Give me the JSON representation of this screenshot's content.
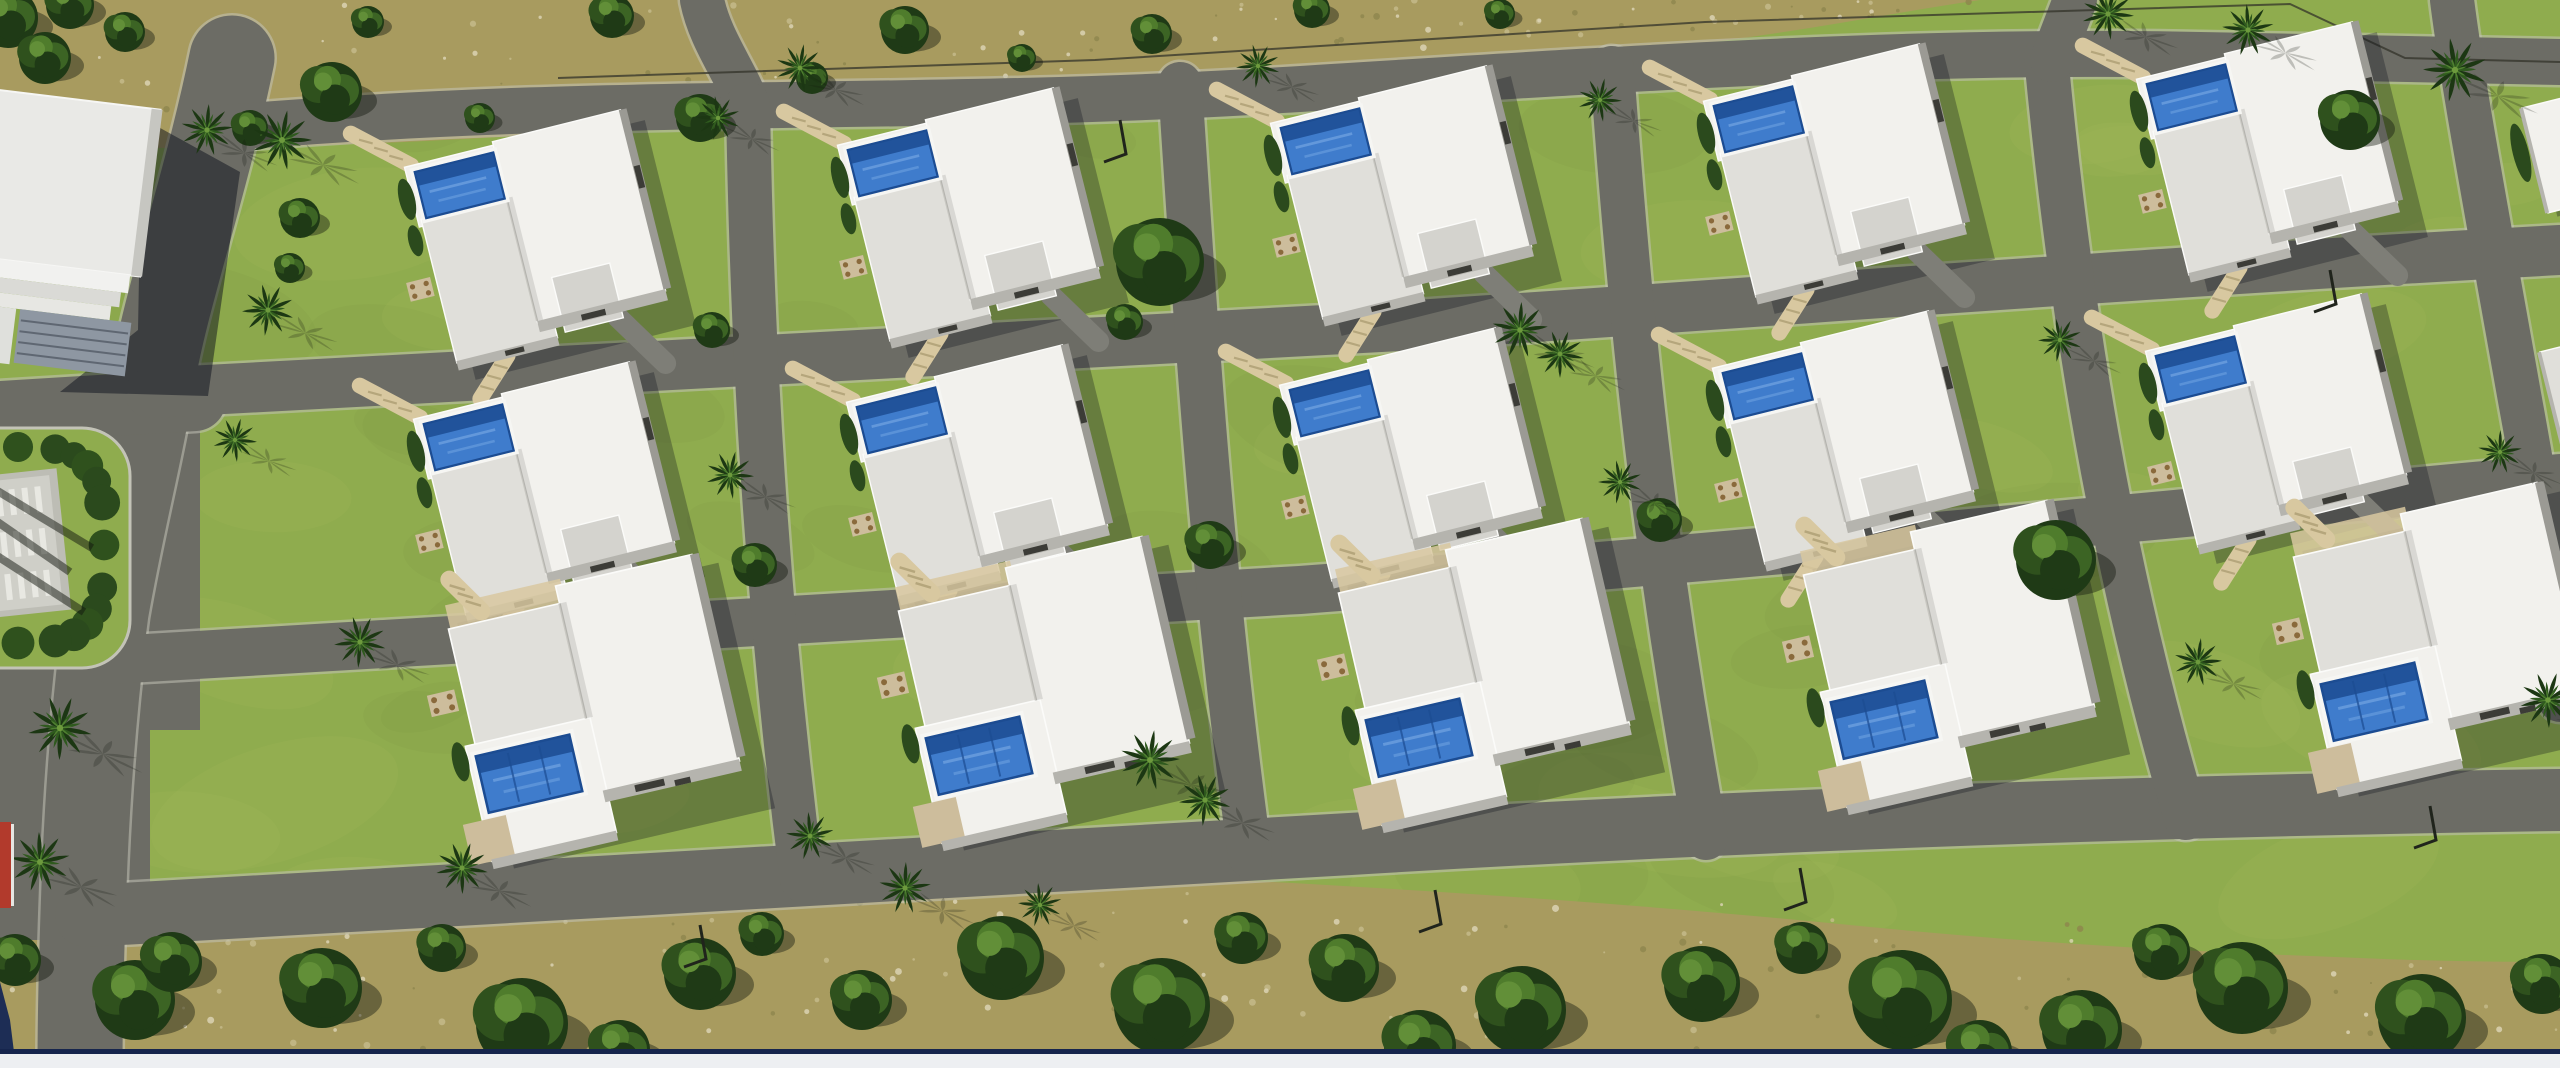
{
  "meta": {
    "description": "Aerial 3D architectural rendering of a residential villa development with white flat-roof houses, blue pools, curved asphalt streets, palm trees and scrubland",
    "canvas": {
      "w": 2560,
      "h": 1068
    }
  },
  "palette": {
    "grass": "#8fac4e",
    "grassLight": "#a6bd60",
    "grassShade": "#7a9842",
    "asphalt": "#6c6c65",
    "curb": "#c3c3b7",
    "scrub": "#a89b5f",
    "scrubDark": "#8d864d",
    "scrubLight": "#c6bb8c",
    "stone": "#ddd6b8",
    "treeDark": "#1f3a16",
    "tree": "#2f511d",
    "treeMid": "#3c6424",
    "treeLight": "#4f7c2c",
    "treeHi": "#628f38",
    "palmDark": "#1c3713",
    "palm": "#2f5a1e",
    "palmLight": "#4f8030",
    "palmCore": "#6d9a3d",
    "shadow": "rgba(18,24,14,0.42)",
    "buildShadow": "rgba(14,18,28,0.30)",
    "clubShadow": "rgba(12,16,28,0.50)",
    "roofWhite": "#f2f1ed",
    "roofGray": "#e0dfda",
    "roofGray2": "#d4d3ce",
    "roofLine": "#fbfbf9",
    "wall": "#b5b4ae",
    "wallDark": "#9b9a94",
    "slot": "#3c3c37",
    "poolRim": "#f6f6f3",
    "poolDeep": "#1c4c92",
    "pool": "#3f7ccc",
    "poolLight": "#76a7e4",
    "deck": "#cdbd9c",
    "path": "#d8c8a0",
    "pathDark": "#b5a67c",
    "drive": "#7e7e77",
    "hedge": "#2b4a1d",
    "monument": "#cfcfc8",
    "monumentIn": "#bdbdb5",
    "monumentBar": "#ececе6",
    "facade": "#8e97a2",
    "facadeLine": "#5f6772",
    "clubRoof": "#e9e9e6",
    "clubEdge": "#c6c6c1",
    "band1": "#f1f1ef",
    "band2": "#dadad6",
    "band3": "#e7e7e3",
    "sideBlock": "#dfe0dc",
    "red": "#b23a2c",
    "redEdge": "#e6e6e2",
    "navy": "#1d2d55",
    "navyLine": "#16254d",
    "bottomBar": "#edeff2",
    "fence": "#33332a",
    "lamp": "#20241c"
  },
  "scrub": {
    "top_path": "M0,0 L1980,0 C1860,18 1760,40 1620,52 C1430,66 1300,62 1150,80 C980,100 860,108 700,122 C540,136 420,142 300,146 C200,150 90,148 0,142 Z",
    "bottom_path": "M0,1054 L0,938 C150,934 290,922 430,912 C600,900 760,888 930,882 C1060,878 1180,876 1310,884 C1500,895 1680,908 1860,926 C2040,944 2200,952 2360,958 C2430,961 2500,962 2560,962 L2560,1054 Z",
    "speckles_top": 90,
    "speckles_bottom": 150,
    "mottle": 70,
    "seed": 7
  },
  "roads": [
    {
      "d": "M 232,58 C 205,190 165,300 152,382 C 140,455 122,520 106,612 C 96,690 89,770 85,860 C 82,935 80,1000 80,1068",
      "w": 85,
      "name": "main-avenue"
    },
    {
      "d": "M 0,412 L 195,400",
      "w": 62,
      "name": "west-spur-road"
    },
    {
      "d": "M 225,128 C 600,96 900,112 1250,92 C 1550,74 1900,48 2200,55 C 2360,58 2470,60 2560,62",
      "w": 46,
      "name": "street-1"
    },
    {
      "d": "M 150,393 C 600,368 1000,348 1400,326 C 1800,300 2150,272 2560,250",
      "w": 50,
      "name": "street-2"
    },
    {
      "d": "M 112,660 C 500,636 900,612 1300,590 C 1700,560 2150,516 2560,478",
      "w": 48,
      "name": "street-3"
    },
    {
      "d": "M 86,916 C 500,892 950,868 1350,844 C 1750,820 2150,806 2560,800",
      "w": 62,
      "name": "street-4"
    },
    {
      "d": "M 702,0 C 710,40 736,72 748,106",
      "w": 44,
      "name": "lane-1-stub"
    },
    {
      "d": "M 748,104 C 752,350 766,600 802,880",
      "w": 44,
      "name": "lane-1"
    },
    {
      "d": "M 1180,84 C 1196,330 1212,580 1250,856",
      "w": 44,
      "name": "lane-2"
    },
    {
      "d": "M 1612,68 C 1630,320 1655,560 1706,838",
      "w": 44,
      "name": "lane-3"
    },
    {
      "d": "M 2046,56 C 2070,310 2110,560 2186,818",
      "w": 44,
      "name": "lane-4"
    },
    {
      "d": "M 2075,0 L 2052,60",
      "w": 44,
      "name": "lane-4-stub"
    },
    {
      "d": "M 2452,0 C 2462,80 2488,220 2520,400 C 2542,520 2556,610 2560,700",
      "w": 44,
      "name": "lane-5"
    }
  ],
  "asphalt_patches": [
    [
      0,
      390,
      200,
      340
    ],
    [
      0,
      640,
      150,
      300
    ]
  ],
  "plaza": {
    "pad": [
      -60,
      428,
      190,
      240
    ],
    "pad_rx": 48,
    "hedge_cx": 18,
    "hedge_cy": 545,
    "hedge_rx": 86,
    "hedge_ry": 98,
    "hedge_blobs": 24,
    "monument": [
      -16,
      478,
      72,
      130
    ],
    "rot": -6,
    "streaks": [
      [
        -40,
        496,
        70,
        572
      ],
      [
        -40,
        532,
        84,
        612
      ],
      [
        -24,
        478,
        92,
        548
      ]
    ]
  },
  "clubhouse": {
    "shadow_pts": "142,118 240,172 208,396 60,392 138,330",
    "rot": 7,
    "rot_cx": 40,
    "rot_cy": 230,
    "roof": [
      -70,
      96,
      215,
      168
    ],
    "edge": [
      136,
      96,
      11,
      168
    ],
    "bands": [
      [
        -70,
        264,
        205,
        18
      ],
      [
        -70,
        282,
        198,
        15
      ],
      [
        -70,
        297,
        190,
        14
      ]
    ],
    "facade": [
      30,
      311,
      112,
      54
    ],
    "facade_lines": [
      322,
      333,
      344,
      355
    ],
    "side_block": [
      -70,
      311,
      96,
      56
    ]
  },
  "villa_variants": {
    "pool_top": {
      "shadow": [
        16,
        4,
        258,
        240
      ],
      "rects": [
        {
          "x": -4,
          "y": -10,
          "w": 112,
          "h": 70,
          "f": "roofWhite"
        },
        {
          "x": 0,
          "y": 52,
          "w": 118,
          "h": 168,
          "f": "roofGray"
        },
        {
          "x": 100,
          "y": -14,
          "w": 150,
          "h": 212,
          "f": "roofWhite"
        },
        {
          "x": 128,
          "y": 152,
          "w": 68,
          "h": 64,
          "f": "roofGray2"
        },
        {
          "x": 0,
          "y": 218,
          "w": 118,
          "h": 11,
          "f": "wall"
        },
        {
          "x": 100,
          "y": 196,
          "w": 150,
          "h": 13,
          "f": "wall"
        },
        {
          "x": 248,
          "y": -14,
          "w": 9,
          "h": 210,
          "f": "wallDark"
        }
      ],
      "seam": [
        100,
        52,
        100,
        196
      ],
      "pool": {
        "x": 6,
        "y": -2,
        "w": 92,
        "h": 54,
        "lanes": 0
      },
      "slots": [
        [
          150,
          201,
          28,
          7
        ],
        [
          56,
          220,
          22,
          6
        ],
        [
          249,
          52,
          7,
          26
        ]
      ],
      "patio": [
        -34,
        118,
        28,
        22
      ],
      "paths": [
        [
          4,
          -10,
          -54,
          -62
        ],
        [
          58,
          226,
          16,
          266
        ]
      ],
      "drive": [
        190,
        214,
        230,
        278
      ],
      "hedges": [
        [
          -10,
          26,
          9,
          24
        ],
        [
          -12,
          74,
          8,
          18
        ]
      ],
      "sand": null
    },
    "pool_bottom": {
      "shadow": [
        14,
        -6,
        268,
        252
      ],
      "rects": [
        {
          "x": 4,
          "y": -2,
          "w": 142,
          "h": 120,
          "f": "roofGray"
        },
        {
          "x": 118,
          "y": -20,
          "w": 140,
          "h": 212,
          "f": "roofWhite"
        },
        {
          "x": -6,
          "y": 116,
          "w": 128,
          "h": 118,
          "f": "roofWhite"
        },
        {
          "x": -26,
          "y": 192,
          "w": 44,
          "h": 42,
          "f": "deck"
        },
        {
          "x": 118,
          "y": 190,
          "w": 140,
          "h": 12,
          "f": "wall"
        },
        {
          "x": 256,
          "y": -20,
          "w": 9,
          "h": 208,
          "f": "wallDark"
        },
        {
          "x": -6,
          "y": 232,
          "w": 128,
          "h": 10,
          "f": "wall"
        }
      ],
      "seam": [
        118,
        -2,
        118,
        116
      ],
      "pool": {
        "x": 2,
        "y": 128,
        "w": 96,
        "h": 58,
        "lanes": 2
      },
      "slots": [
        [
          150,
          192,
          30,
          7
        ],
        [
          190,
          196,
          16,
          6
        ]
      ],
      "patio": [
        -32,
        58,
        28,
        22
      ],
      "paths": [
        [
          40,
          -12,
          16,
          -50
        ]
      ],
      "drive": null,
      "hedges": [
        [
          -14,
          130,
          8,
          20
        ]
      ],
      "sand": [
        6,
        -26,
        118,
        24
      ]
    }
  },
  "villa_rows": [
    {
      "variant": "pool_top",
      "rot": -14,
      "scale": 0.88,
      "origins": [
        [
          410,
          175
        ],
        [
          843,
          153
        ],
        [
          1276,
          131
        ],
        [
          1709,
          109
        ],
        [
          2142,
          87
        ]
      ]
    },
    {
      "variant": "pool_top",
      "rot": -14,
      "scale": 0.88,
      "origins": [
        [
          419,
          427
        ],
        [
          852,
          410
        ],
        [
          1285,
          393
        ],
        [
          1718,
          376
        ],
        [
          2151,
          359
        ]
      ]
    },
    {
      "variant": "pool_bottom",
      "rot": -13,
      "scale": 1.0,
      "origins": [
        [
          445,
          632
        ],
        [
          895,
          614
        ],
        [
          1335,
          596
        ],
        [
          1800,
          578
        ],
        [
          2290,
          560
        ]
      ]
    }
  ],
  "partial_buildings": [
    {
      "x": 2522,
      "y": 108,
      "w": 70,
      "h": 108,
      "rot": -14,
      "f": "roofWhite",
      "hedge": true
    },
    {
      "x": 2540,
      "y": 352,
      "w": 55,
      "h": 96,
      "rot": -14,
      "f": "roofGray",
      "hedge": false
    }
  ],
  "trees_scrub_top": [
    [
      8,
      18,
      30
    ],
    [
      70,
      5,
      24
    ],
    [
      45,
      58,
      26
    ],
    [
      125,
      32,
      20
    ],
    [
      250,
      128,
      18
    ],
    [
      332,
      92,
      30
    ],
    [
      368,
      22,
      16
    ],
    [
      480,
      118,
      15
    ],
    [
      612,
      16,
      22
    ],
    [
      700,
      118,
      24
    ],
    [
      812,
      78,
      16
    ],
    [
      905,
      30,
      24
    ],
    [
      1022,
      58,
      14
    ],
    [
      1152,
      34,
      20
    ],
    [
      1312,
      10,
      18
    ],
    [
      1500,
      14,
      15
    ]
  ],
  "trees_dev": [
    [
      1160,
      262,
      44
    ],
    [
      2056,
      560,
      40
    ],
    [
      2350,
      120,
      30
    ],
    [
      300,
      218,
      20
    ],
    [
      290,
      268,
      15
    ],
    [
      755,
      565,
      22
    ],
    [
      1210,
      545,
      24
    ],
    [
      1660,
      520,
      22
    ],
    [
      712,
      330,
      18
    ],
    [
      1125,
      322,
      18
    ]
  ],
  "trees_bottom": [
    [
      135,
      1000,
      40
    ],
    [
      15,
      960,
      26
    ],
    [
      172,
      962,
      30
    ],
    [
      322,
      988,
      40
    ],
    [
      522,
      1024,
      46
    ],
    [
      700,
      974,
      36
    ],
    [
      862,
      1000,
      30
    ],
    [
      1002,
      958,
      42
    ],
    [
      1162,
      1006,
      48
    ],
    [
      1345,
      968,
      34
    ],
    [
      1522,
      1010,
      44
    ],
    [
      1702,
      984,
      38
    ],
    [
      1902,
      1000,
      50
    ],
    [
      2082,
      1030,
      40
    ],
    [
      2242,
      988,
      46
    ],
    [
      2422,
      1018,
      44
    ],
    [
      2542,
      984,
      30
    ],
    [
      1242,
      938,
      26
    ],
    [
      762,
      934,
      22
    ],
    [
      442,
      948,
      24
    ],
    [
      1802,
      948,
      26
    ],
    [
      2162,
      952,
      28
    ],
    [
      620,
      1050,
      30
    ],
    [
      1420,
      1046,
      36
    ],
    [
      1980,
      1052,
      32
    ]
  ],
  "palms": [
    [
      282,
      140,
      30
    ],
    [
      268,
      310,
      26
    ],
    [
      207,
      130,
      26
    ],
    [
      60,
      728,
      32
    ],
    [
      40,
      862,
      30
    ],
    [
      235,
      440,
      22
    ],
    [
      718,
      118,
      22
    ],
    [
      800,
      68,
      24
    ],
    [
      1258,
      66,
      22
    ],
    [
      1520,
      330,
      28
    ],
    [
      1560,
      354,
      24
    ],
    [
      2248,
      30,
      26
    ],
    [
      2108,
      14,
      26
    ],
    [
      2455,
      70,
      32
    ],
    [
      1150,
      760,
      30
    ],
    [
      1205,
      800,
      26
    ],
    [
      905,
      888,
      26
    ],
    [
      462,
      868,
      26
    ],
    [
      810,
      836,
      24
    ],
    [
      730,
      475,
      24
    ],
    [
      1620,
      482,
      22
    ],
    [
      2198,
      662,
      24
    ],
    [
      360,
      642,
      26
    ],
    [
      2500,
      452,
      22
    ],
    [
      2548,
      700,
      28
    ],
    [
      1040,
      905,
      22
    ],
    [
      1600,
      100,
      22
    ],
    [
      2060,
      340,
      22
    ]
  ],
  "fence_points": "558,78 1095,60 1705,22 2290,4 2405,58 2560,62",
  "lamps": [
    [
      1435,
      890
    ],
    [
      1800,
      868
    ],
    [
      2430,
      806
    ],
    [
      700,
      925
    ],
    [
      1120,
      120
    ],
    [
      2330,
      270
    ]
  ],
  "red_court": {
    "rect": [
      0,
      822,
      11,
      86
    ],
    "edge": [
      11,
      824,
      3,
      82
    ]
  },
  "ui": {
    "corner_wedge": "0,982 10,1020 16,1068 0,1068",
    "navy_line": [
      0,
      1049,
      2560,
      5
    ],
    "bottom_bar": [
      0,
      1054,
      2560,
      14
    ]
  }
}
